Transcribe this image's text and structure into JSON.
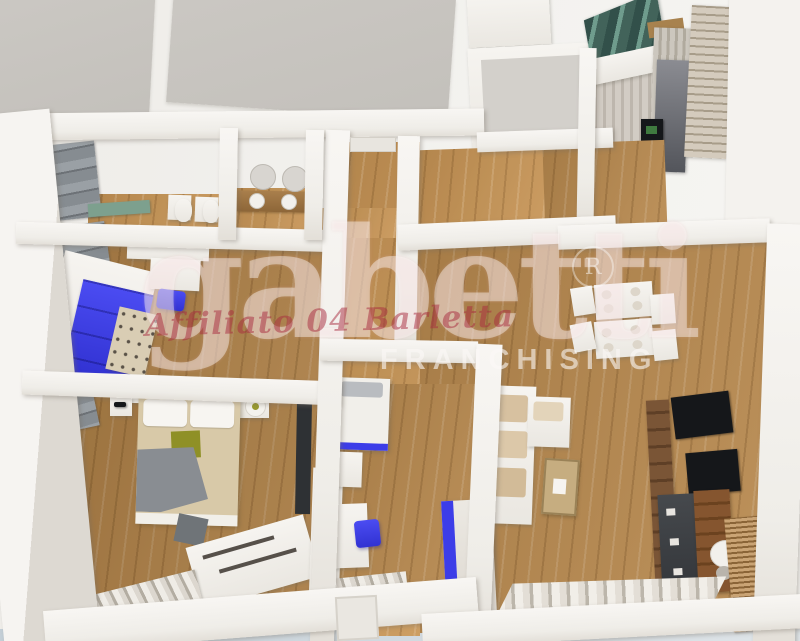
{
  "watermark": {
    "brand": "gabetti",
    "subtitle": "FRANCHISING",
    "affiliate_script": "Affiliato 04 Barletta",
    "registered_mark": "R"
  },
  "colors": {
    "accent": "#3c3de8",
    "wood": "#b8894e",
    "wall": "#f4f2ee",
    "roof": "#c8c5c0",
    "charcoal": "#54565c",
    "teal-glass": "#44645a",
    "bed-beige": "#d8c9a8",
    "olive-pillow": "#8f9026",
    "tv-black": "#15171a",
    "tv-board-brown": "#6e4c32",
    "script-pink": "#a82a3e",
    "edge-blue": "#b6c2cc"
  }
}
